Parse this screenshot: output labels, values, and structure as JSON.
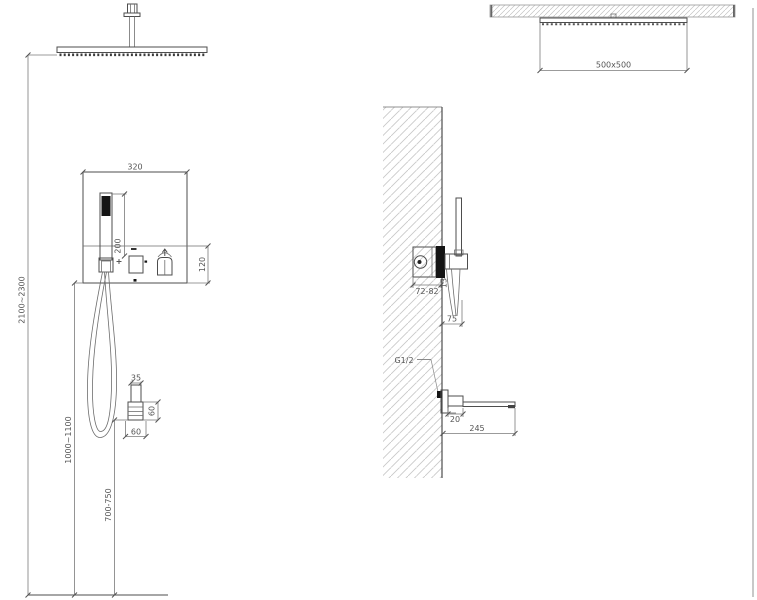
{
  "drawing": {
    "type": "shower-system-installation-diagram",
    "front_view": {
      "overall_height": "2100~2300",
      "panel_width": "320",
      "handshower_height": "200",
      "panel_lower_height": "120",
      "valve_height": "1000~1100",
      "spout_height": "700-750",
      "spout_neck_width": "35",
      "spout_body_height": "60",
      "spout_body_width": "60"
    },
    "side_view": {
      "head_size": "500x500",
      "valve_depth": "72-82",
      "trim_thickness": "13",
      "holder_projection": "75",
      "connection_thread": "G1/2",
      "spout_drop": "20",
      "spout_length": "245"
    }
  }
}
